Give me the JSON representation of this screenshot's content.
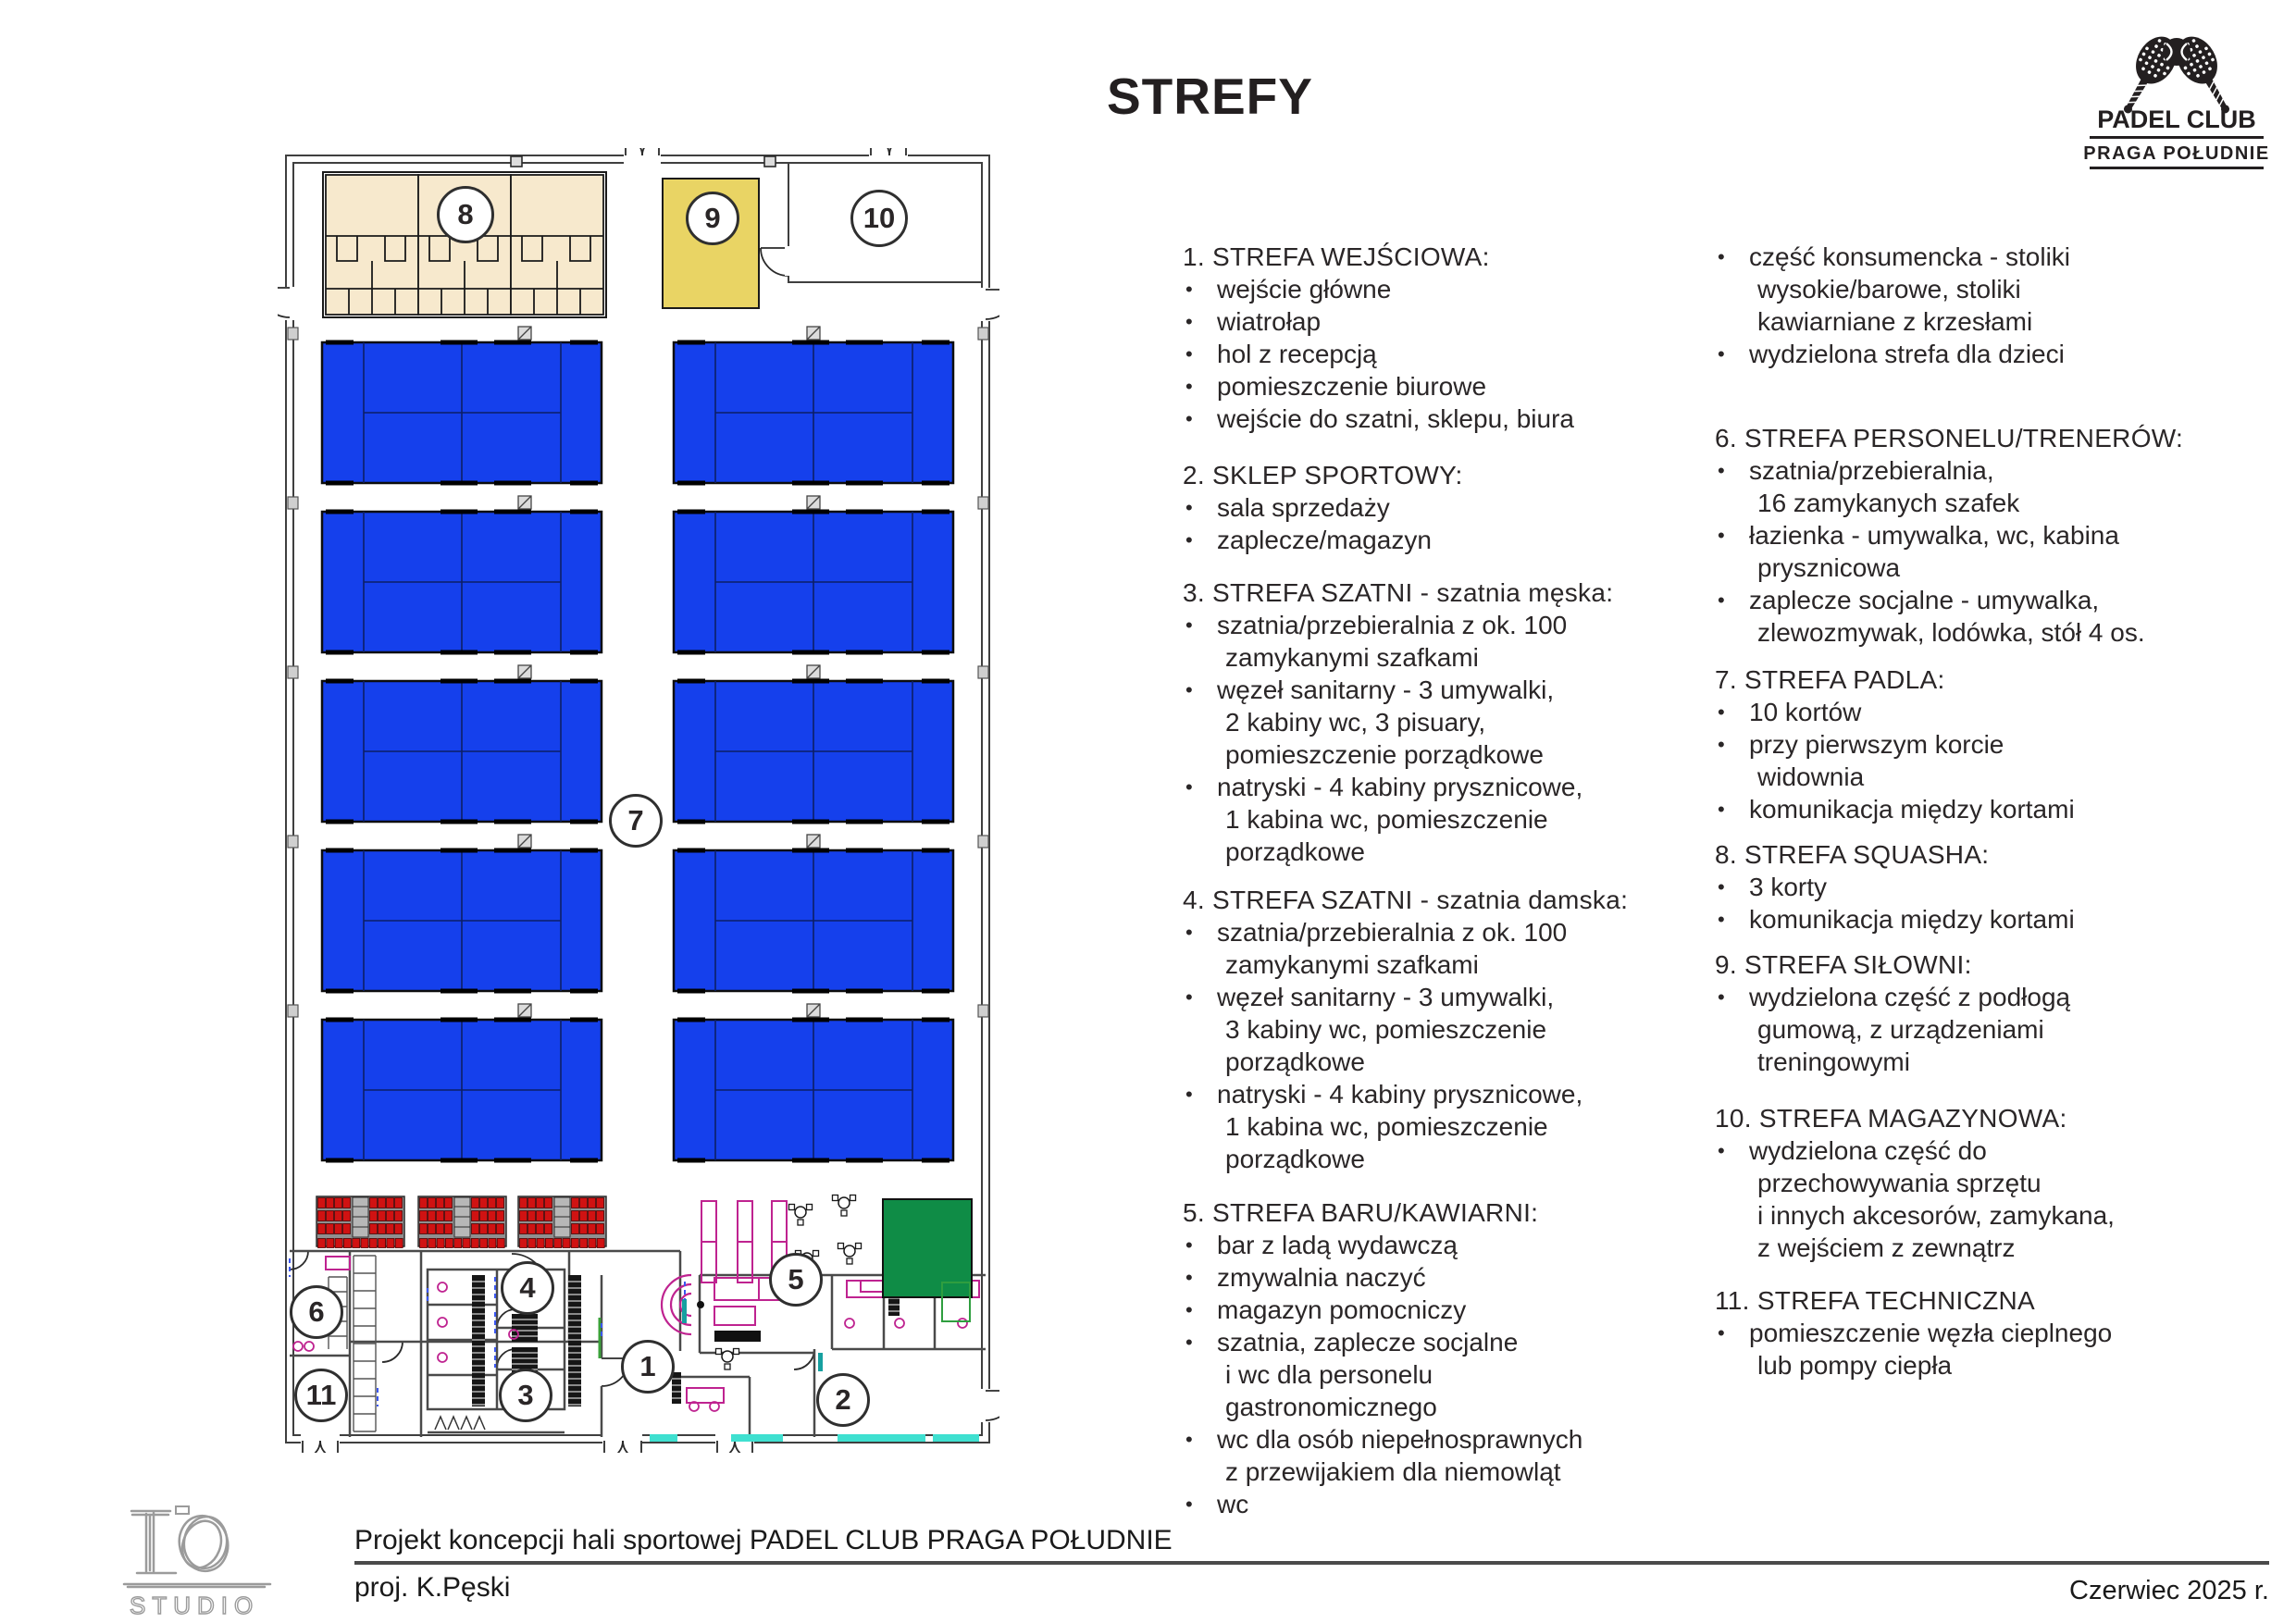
{
  "title": "STREFY",
  "logo": {
    "name": "PADEL CLUB",
    "subtitle": "PRAGA POŁUDNIE"
  },
  "footer": {
    "project": "Projekt koncepcji hali sportowej PADEL CLUB PRAGA POŁUDNIE",
    "author": "proj. K.Pęski",
    "date": "Czerwiec 2025 r.",
    "studio": "STUDIO"
  },
  "zones": [
    {
      "n": "1"
    },
    {
      "n": "2"
    },
    {
      "n": "3"
    },
    {
      "n": "4"
    },
    {
      "n": "5"
    },
    {
      "n": "6"
    },
    {
      "n": "7"
    },
    {
      "n": "8"
    },
    {
      "n": "9"
    },
    {
      "n": "10"
    },
    {
      "n": "11"
    }
  ],
  "colors": {
    "court": "#1540ec",
    "squash": "#f7e9cd",
    "gym": "#e9d464",
    "mat": "#0f8c46",
    "seat": "#d01212",
    "seat_dark": "#4d0404",
    "stand": "#8f8f8f",
    "accent": "#bf2390",
    "sill": "#3fe0d0",
    "teal": "#16a0a0",
    "wall": "#3f3f3f",
    "green_door": "#3aa03a"
  },
  "legend": {
    "columns": [
      {
        "sections": [
          {
            "header": "1. STREFA WEJŚCIOWA:",
            "items": [
              [
                "wejście główne"
              ],
              [
                "wiatrołap"
              ],
              [
                "hol z recepcją"
              ],
              [
                "pomieszczenie biurowe"
              ],
              [
                "wejście do szatni, sklepu, biura"
              ]
            ]
          },
          {
            "header": "2. SKLEP SPORTOWY:",
            "items": [
              [
                "sala sprzedaży"
              ],
              [
                "zaplecze/magazyn"
              ]
            ]
          },
          {
            "header": "3. STREFA SZATNI - szatnia męska:",
            "items": [
              [
                "szatnia/przebieralnia z ok. 100",
                "zamykanymi szafkami"
              ],
              [
                "węzeł sanitarny - 3 umywalki,",
                "2 kabiny wc, 3 pisuary,",
                "pomieszczenie porządkowe"
              ],
              [
                "natryski - 4 kabiny prysznicowe,",
                "1 kabina wc, pomieszczenie",
                "porządkowe"
              ]
            ]
          },
          {
            "header": "4. STREFA SZATNI - szatnia damska:",
            "items": [
              [
                "szatnia/przebieralnia z ok. 100",
                "zamykanymi szafkami"
              ],
              [
                "węzeł sanitarny - 3 umywalki,",
                "3 kabiny wc, pomieszczenie",
                "porządkowe"
              ],
              [
                "natryski - 4 kabiny prysznicowe,",
                "1 kabina wc, pomieszczenie",
                "porządkowe"
              ]
            ]
          },
          {
            "header": "5. STREFA BARU/KAWIARNI:",
            "items": [
              [
                "bar z ladą wydawczą"
              ],
              [
                "zmywalnia naczyć"
              ],
              [
                "magazyn pomocniczy"
              ],
              [
                "szatnia, zaplecze socjalne",
                "i wc dla personelu",
                "gastronomicznego"
              ],
              [
                "wc dla osób niepełnosprawnych",
                "z przewijakiem dla niemowląt"
              ],
              [
                "wc"
              ]
            ]
          }
        ]
      },
      {
        "sections": [
          {
            "header": null,
            "items": [
              [
                "część konsumencka - stoliki",
                "wysokie/barowe, stoliki",
                "kawiarniane z krzesłami"
              ],
              [
                "wydzielona strefa dla dzieci"
              ]
            ]
          },
          {
            "header": "6. STREFA PERSONELU/TRENERÓW:",
            "items": [
              [
                "szatnia/przebieralnia,",
                "16 zamykanych szafek"
              ],
              [
                "łazienka - umywalka, wc, kabina",
                "prysznicowa"
              ],
              [
                "zaplecze socjalne - umywalka,",
                "zlewozmywak, lodówka, stół 4 os."
              ]
            ]
          },
          {
            "header": "7. STREFA PADLA:",
            "items": [
              [
                "10 kortów"
              ],
              [
                "przy pierwszym korcie",
                "widownia"
              ],
              [
                "komunikacja między kortami"
              ]
            ]
          },
          {
            "header": "8. STREFA SQUASHA:",
            "items": [
              [
                "3 korty"
              ],
              [
                "komunikacja między kortami"
              ]
            ]
          },
          {
            "header": "9. STREFA SIŁOWNI:",
            "items": [
              [
                "wydzielona część z podłogą",
                "gumową, z urządzeniami",
                "treningowymi"
              ]
            ]
          },
          {
            "header": "10. STREFA MAGAZYNOWA:",
            "items": [
              [
                "wydzielona część do",
                "przechowywania sprzętu",
                "i innych akcesorów, zamykana,",
                "z wejściem z zewnątrz"
              ]
            ]
          },
          {
            "header": "11. STREFA TECHNICZNA",
            "items": [
              [
                "pomieszczenie węzła cieplnego",
                "lub pompy ciepła"
              ]
            ]
          }
        ]
      }
    ]
  }
}
